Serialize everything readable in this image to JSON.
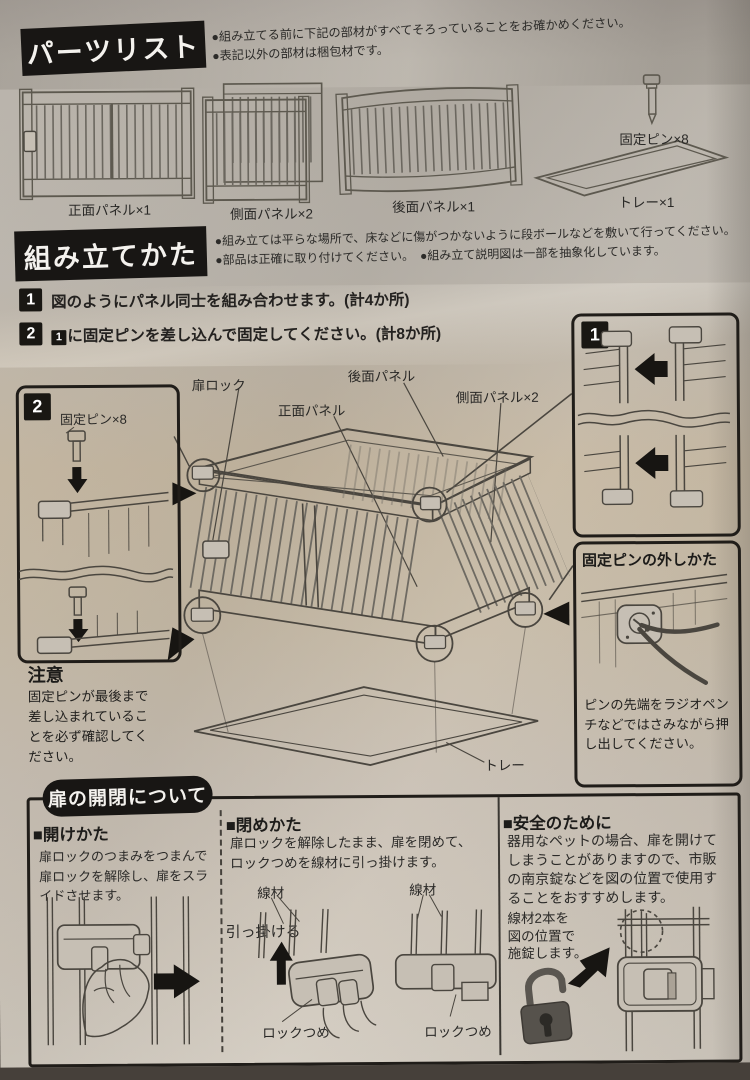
{
  "parts": {
    "header": "パーツリスト",
    "note1": "●組み立てる前に下記の部材がすべてそろっていることをお確かめください。",
    "note2": "●表記以外の部材は梱包材です。",
    "front_panel": "正面パネル×1",
    "side_panel": "側面パネル×2",
    "back_panel": "後面パネル×1",
    "pin": "固定ピン×8",
    "tray": "トレー×1"
  },
  "assembly": {
    "header": "組み立てかた",
    "note1": "●組み立ては平らな場所で、床などに傷がつかないように段ボールなどを敷いて行ってください。",
    "note2": "●部品は正確に取り付けてください。　●組み立て説明図は一部を抽象化しています。",
    "step1_num": "1",
    "step1_text": "図のようにパネル同士を組み合わせます。(計4か所)",
    "step2_num": "2",
    "step2_ref": "1",
    "step2_text": "に固定ピンを差し込んで固定してください。(計8か所)",
    "inset1_num": "1",
    "inset2_num": "2",
    "pin_label": "固定ピン×8",
    "labels": {
      "door_lock": "扉ロック",
      "front_panel": "正面パネル",
      "back_panel": "後面パネル",
      "side_panel": "側面パネル×2",
      "tray": "トレー"
    },
    "pin_removal_title": "固定ピンの外しかた",
    "pin_removal_text": "ピンの先端をラジオペンチなどではさみながら押し出してください。",
    "caution_title": "注意",
    "caution_text": "固定ピンが最後まで差し込まれていることを必ず確認してください。"
  },
  "door": {
    "header": "扉の開閉について",
    "open_title": "■開けかた",
    "open_text": "扉ロックのつまみをつまんで扉ロックを解除し、扉をスライドさせます。",
    "close_title": "■閉めかた",
    "close_text": "扉ロックを解除したまま、扉を閉めて、ロックつめを線材に引っ掛けます。",
    "wire": "線材",
    "hook": "引っ掛ける",
    "claw": "ロックつめ",
    "safety_title": "■安全のために",
    "safety_text": "器用なペットの場合、扉を開けてしまうことがありますので、市販の南京錠などを図の位置で使用することをおすすめします。",
    "safety_note_l1": "線材2本を",
    "safety_note_l2": "図の位置で",
    "safety_note_l3": "施錠します。"
  }
}
